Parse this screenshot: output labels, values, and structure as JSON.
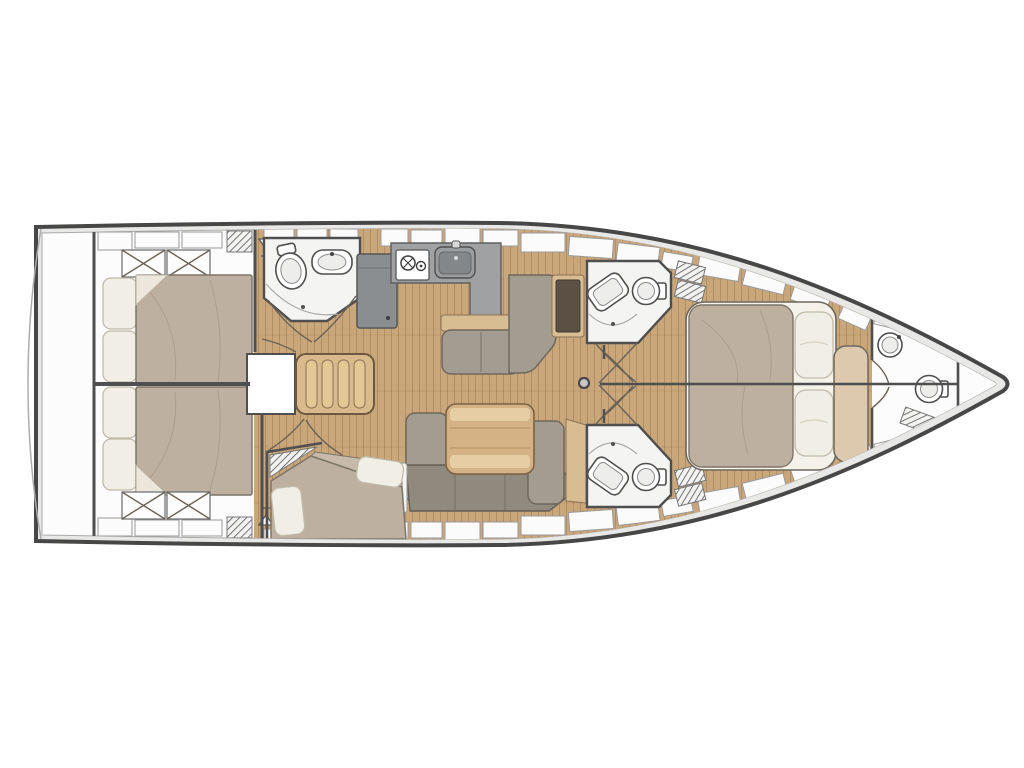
{
  "page": {
    "background": "#ffffff"
  },
  "diagram": {
    "type": "yacht-interior-floor-plan",
    "orientation": "bow-right-stern-left",
    "rooms": [
      {
        "id": "swim-platform",
        "label": "Transom swim platform"
      },
      {
        "id": "aft-cabin-port",
        "label": "Aft double cabin (port)"
      },
      {
        "id": "aft-cabin-starboard",
        "label": "Aft double cabin (starboard)"
      },
      {
        "id": "companionway",
        "label": "Companionway steps"
      },
      {
        "id": "aft-head",
        "label": "Aft head with toilet and basin"
      },
      {
        "id": "galley",
        "label": "L-shaped galley with stove, sink and fridge"
      },
      {
        "id": "saloon",
        "label": "Saloon with L-sofa and chart table"
      },
      {
        "id": "dinette",
        "label": "Dinette with table and wraparound sofa"
      },
      {
        "id": "bunk-cabin",
        "label": "Angled bunk berth cabin"
      },
      {
        "id": "mid-head-port",
        "label": "Midship head (port) with toilet and basin"
      },
      {
        "id": "mid-head-starboard",
        "label": "Midship head (starboard) with toilet and basin"
      },
      {
        "id": "owner-cabin",
        "label": "Forward owner cabin with island double bed and bench"
      },
      {
        "id": "bow-head",
        "label": "Forward head in bow with toilet and basin"
      },
      {
        "id": "anchor-locker",
        "label": "Bow anchor locker"
      }
    ],
    "furniture_counts": {
      "double_beds": 3,
      "single_berths": 1,
      "toilets": 4,
      "basins": 4,
      "stove_burners": 2,
      "galley_sinks": 1,
      "tables": 2,
      "sofas": 3,
      "wardrobe_lockers": 4,
      "vent_grilles": 8,
      "hatches_and_lockers": 24
    }
  },
  "colors": {
    "page_bg": "#ffffff",
    "hull_outline": "#474747",
    "deck": "#e8e8e7",
    "interior": "#fcfcfc",
    "wall": "#4f4f4f",
    "line_mid": "#9a9a9a",
    "white_panel": "#fbfbfb",
    "wood_floor": "#c9a77b",
    "wood_trim": "#d8bd92",
    "counter": "#9fa1a3",
    "appliance": "#8b8e90",
    "sofa": "#a29c91",
    "sofa_dark": "#8f897e",
    "bed": "#bdb0a0",
    "pillow": "#f1eee5",
    "head_floor": "#f4f4f2",
    "table": "#d4b285",
    "table_light": "#e6cda3",
    "dark_panel": "#5c5044",
    "stairs": "#d9ba8c"
  }
}
